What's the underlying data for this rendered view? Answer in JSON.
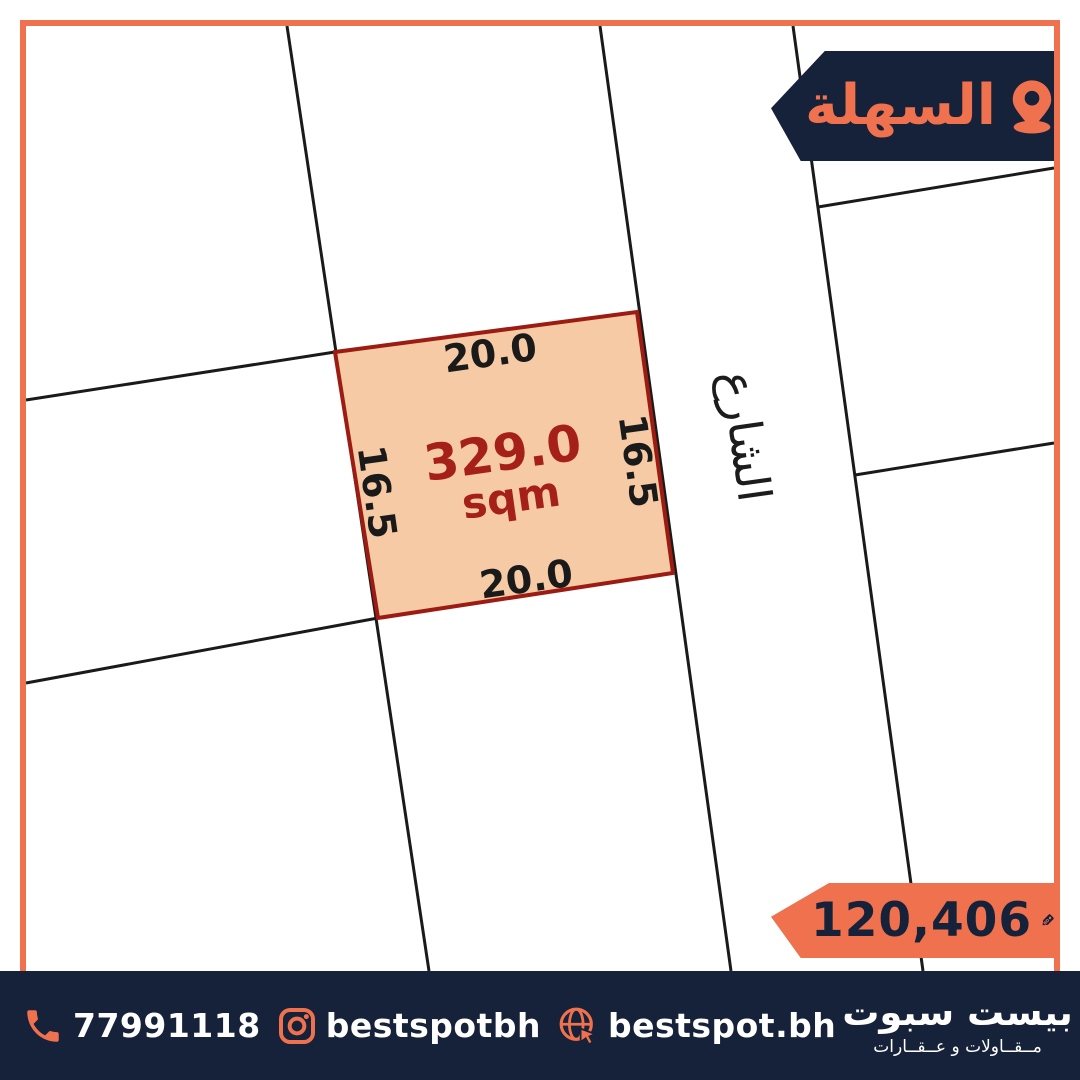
{
  "location_banner": {
    "area_name": "السهلة"
  },
  "map": {
    "street_label": "الشارع",
    "plot": {
      "area_value": "329.0",
      "area_unit": "sqm",
      "side_top": "20.0",
      "side_bottom": "20.0",
      "side_left": "16.5",
      "side_right": "16.5"
    }
  },
  "price_badge": {
    "amount": "120,406",
    "currency_code": "BD"
  },
  "footer": {
    "phone": "77991118",
    "instagram_handle": "bestspotbh",
    "website": "bestspot.bh",
    "brand_name": "بيست سبوت",
    "brand_tagline": "مــقــاولات و عــقــارات"
  },
  "colors": {
    "accent_orange": "#F0714D",
    "navy": "#16213A",
    "plot_fill": "#F5CAA4",
    "plot_border": "#9C1B13",
    "area_text": "#A6201A",
    "parcel_line": "#1A1A1A"
  }
}
